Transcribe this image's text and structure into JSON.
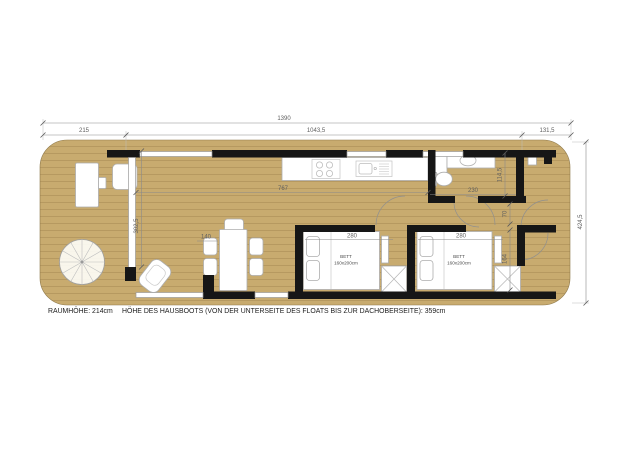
{
  "plan": {
    "title_context": "houseboat floor plan",
    "dimensions": {
      "total_length": "1390",
      "front_terrace": "215",
      "main_section": "1043,5",
      "rear_section": "131,5",
      "total_width": "424,5",
      "living_length": "767",
      "bath_width": "230",
      "bath_depth": "114,5",
      "glass_front_height": "302,5",
      "corridor_width": "70",
      "closet_depth": "164",
      "table_width": "140",
      "bedroom1_width": "280",
      "bedroom2_width": "280"
    },
    "labels": {
      "bed1_name": "BETT",
      "bed1_size": "160x200cm",
      "bed2_name": "BETT",
      "bed2_size": "160x200cm"
    },
    "footer": {
      "room_height": "RAUMHÖHE: 214cm",
      "boat_height": "HÖHE DES HAUSBOOTS (VON DER UNTERSEITE DES FLOATS BIS ZUR DACHOBERSEITE): 359cm"
    },
    "colors": {
      "deck": "#c8ab6f",
      "plank_line": "#b2955c",
      "wall": "#161616",
      "dimension": "#5f5f5f",
      "furniture": "#ffffff"
    }
  }
}
